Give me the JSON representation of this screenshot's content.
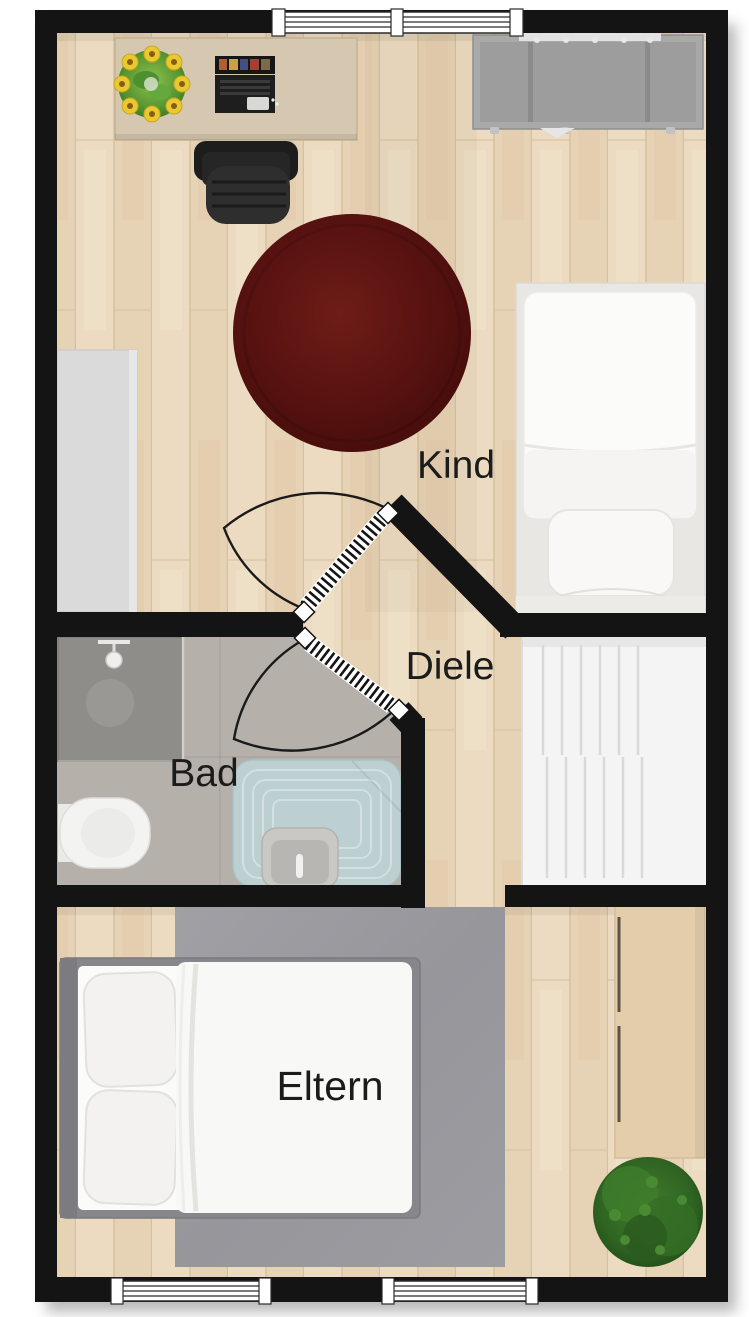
{
  "floorplan": {
    "type": "apartment-floor-plan-top-view",
    "rooms": [
      {
        "name": "kind",
        "label": "Kind"
      },
      {
        "name": "diele",
        "label": "Diele"
      },
      {
        "name": "bad",
        "label": "Bad"
      },
      {
        "name": "eltern",
        "label": "Eltern"
      }
    ],
    "colors": {
      "walls": "#141414",
      "wood_floor_light": "#eddcc2",
      "wood_floor_dark": "#e6d2b4",
      "bath_floor": "#b5b0aa",
      "kind_rug": "#5a1411",
      "eltern_rug": "#9a9aa0",
      "bathtub": "#bccfd1",
      "stairs": "#f4f4f4",
      "shelf_gray": "#a9a9a9",
      "desk_wood": "#d6c8b0",
      "wardrobe_wood": "#e3cdab",
      "plant_green": "#2f6423",
      "bed_white": "#fafafa"
    }
  }
}
